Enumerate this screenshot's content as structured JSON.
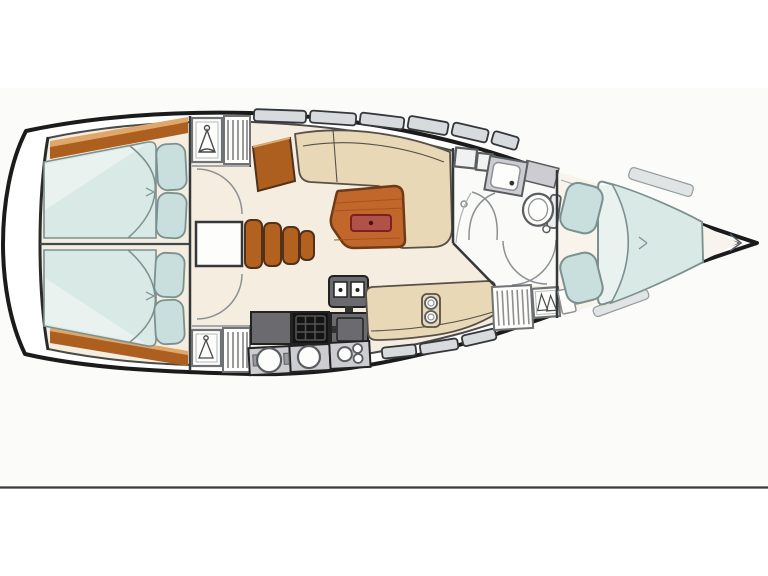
{
  "figure": {
    "type": "boat-floor-plan",
    "description": "Top-view interior layout plan of a sailing yacht, bow pointing right",
    "regions": [
      {
        "name": "stern-swim-platform"
      },
      {
        "name": "aft-cabin-upper",
        "features": [
          "double-berth",
          "pillows",
          "wood-trim"
        ]
      },
      {
        "name": "aft-cabin-lower",
        "features": [
          "double-berth",
          "pillows",
          "wood-trim"
        ]
      },
      {
        "name": "companionway",
        "features": [
          "entry-box",
          "wood-steps"
        ]
      },
      {
        "name": "wardrobe-lockers-aft",
        "features": [
          "hanging-locker",
          "slatted-locker"
        ]
      },
      {
        "name": "nav-station",
        "features": [
          "chart-table",
          "nav-seat"
        ]
      },
      {
        "name": "saloon",
        "features": [
          "l-shaped-settee",
          "straight-settee",
          "wood-table",
          "table-inset"
        ]
      },
      {
        "name": "galley",
        "features": [
          "counter",
          "stove-grid",
          "oven-unit",
          "fridge",
          "round-sinks"
        ]
      },
      {
        "name": "head-compartment",
        "features": [
          "cabinets",
          "sink",
          "toilet",
          "shower-doors",
          "drain"
        ]
      },
      {
        "name": "wardrobe-forward",
        "features": [
          "slatted-locker",
          "hanging-locker"
        ]
      },
      {
        "name": "forward-cabin",
        "features": [
          "island-double-berth",
          "two-pillows",
          "side-shelves"
        ]
      },
      {
        "name": "bow-locker"
      },
      {
        "name": "hull-windows"
      }
    ]
  },
  "palette": {
    "page_bg": "#ffffff",
    "photo_bg": "#fbfbf9",
    "photo_edge": "#3a3a3a",
    "hull_fill": "#ffffff",
    "hull_stroke": "#1b1b1b",
    "deck_stroke": "#4a4a4a",
    "transom": "#2a2a2a",
    "floor_main": "#f5eee0",
    "floor_head": "#fafaf8",
    "floor_fwd": "#f8f4ec",
    "wall": "#35383a",
    "divider": "#3e4a4c",
    "berth": "#d8e9e6",
    "berth_sheet": "#e9f2ef",
    "berth_stroke": "#7b908f",
    "pillow": "#c9dfdd",
    "wood": "#ad5f20",
    "wood_light": "#dfa76a",
    "wood_dark": "#53301a",
    "step": "#b2611f",
    "table": "#c2672b",
    "table_stroke": "#6e3a17",
    "table_lines": "#a9521e",
    "inset": "#b0514a",
    "inset_stroke": "#7c2020",
    "inset_dot": "#4c1010",
    "settee": "#e8d8b6",
    "settee_stroke": "#57514a",
    "counter_dark": "#6b6b6f",
    "counter_mid": "#9a9a9e",
    "counter_light": "#cdcdd1",
    "appliance_stroke": "#222222",
    "stove": "#141414",
    "stove_grid": "#555555",
    "white": "#fdfdfc",
    "fixture_fill": "#f0f2f2",
    "fixture_stroke": "#5a5e60",
    "tank_fill": "#eceeee",
    "window_fill": "#d7dbdd",
    "window_stroke": "#34383b",
    "window_soft_fill": "#e0e4e4",
    "window_soft_stroke": "#949c9e",
    "wardrobe_stroke": "#6f7376",
    "wardrobe_inner": "#b8b8b8",
    "slat": "#8f8f8f",
    "arc": "#8d9194",
    "icon": "#4a4a4a",
    "shelf_line": "#b0b4b6",
    "handle": "#333333"
  }
}
